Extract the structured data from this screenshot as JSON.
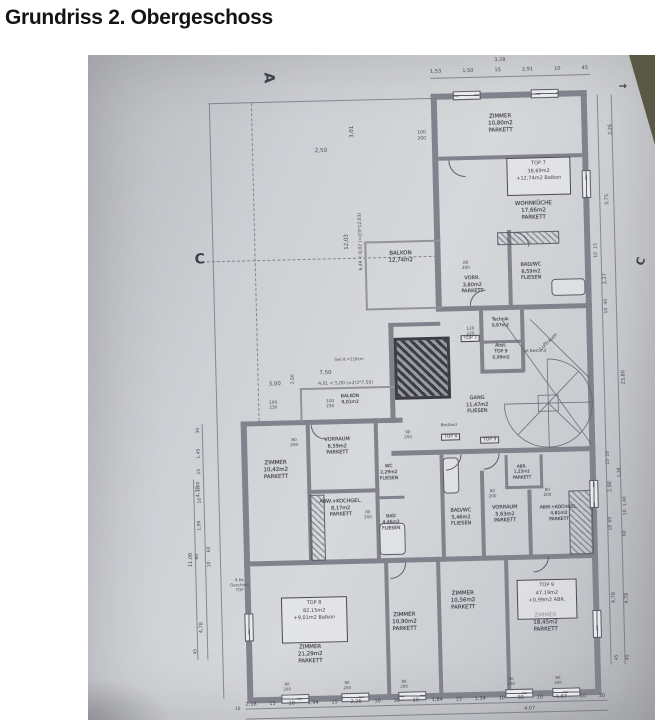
{
  "title": "Grundriss 2. Obergeschoss",
  "plan": {
    "section_markers": {
      "a": "A",
      "c_left": "C",
      "c_right": "C",
      "corner_arrow": "→"
    },
    "unit_boxes": [
      {
        "lines": [
          "TOP 7",
          "38,69m2",
          "+12,74m2 Balkon"
        ],
        "x": 424,
        "y": 106,
        "w": 58,
        "h": 32
      },
      {
        "lines": [
          "TOP 8",
          "82,15m2",
          "+9,01m2 Balkon"
        ],
        "x": 188,
        "y": 540,
        "w": 60,
        "h": 40
      },
      {
        "lines": [
          "TOP 9",
          "47,19m2",
          "+0,99m2 ABR."
        ],
        "x": 424,
        "y": 528,
        "w": 54,
        "h": 34
      }
    ],
    "door_labels": [
      {
        "t": "TOP 7",
        "x": 374,
        "y": 282
      },
      {
        "t": "TOP 8",
        "x": 352,
        "y": 380
      },
      {
        "t": "TOP 9",
        "x": 391,
        "y": 384
      }
    ],
    "rooms": [
      {
        "n": "ZIMMER",
        "a": "10,80m2",
        "f": "PARKETT",
        "x": 419,
        "y": 72
      },
      {
        "n": "WOHNKÜCHE",
        "a": "17,66m2",
        "f": "PARKETT",
        "x": 450,
        "y": 160
      },
      {
        "n": "BALKON",
        "a": "12,74m2",
        "x": 316,
        "y": 203
      },
      {
        "n": "VORR.",
        "a": "3,80m2",
        "f": "PARKETT",
        "x": 387,
        "y": 232,
        "s": 5
      },
      {
        "n": "BAD/WC",
        "a": "6,59m2",
        "f": "FLIESEN",
        "x": 446,
        "y": 220,
        "s": 5
      },
      {
        "n": "Technik",
        "a": "0,97m2",
        "x": 414,
        "y": 271,
        "s": 4.5
      },
      {
        "n": "Abst.",
        "a": "TOP 9",
        "f": "0,99m2",
        "x": 414,
        "y": 300,
        "s": 4.5
      },
      {
        "n": "GANG",
        "a": "11,47m2",
        "f": "FLIESEN",
        "x": 389,
        "y": 352,
        "s": 5
      },
      {
        "n": "BALKON",
        "a": "9,01m2",
        "x": 262,
        "y": 344,
        "s": 4.5
      },
      {
        "n": "VORRAUM",
        "a": "6,59m2",
        "f": "PARKETT",
        "x": 248,
        "y": 390,
        "s": 5
      },
      {
        "n": "ZIMMER",
        "a": "10,42m2",
        "f": "PARKETT",
        "x": 186,
        "y": 413,
        "s": 5.5
      },
      {
        "n": "WC",
        "a": "2,29m2",
        "f": "FLIESEN",
        "x": 299,
        "y": 418,
        "s": 4.5
      },
      {
        "n": "ABW.+KOCHGEL.",
        "a": "8,17m2",
        "f": "PARKETT",
        "x": 250,
        "y": 452,
        "s": 5
      },
      {
        "n": "BAD",
        "a": "4,46m2",
        "f": "FLIESEN",
        "x": 300,
        "y": 468,
        "s": 4.5
      },
      {
        "n": "BAD/WC",
        "a": "5,46m2",
        "f": "FLIESEN",
        "x": 370,
        "y": 464,
        "s": 5
      },
      {
        "n": "VORRAUM",
        "a": "5,63m2",
        "f": "PARKETT",
        "x": 414,
        "y": 462,
        "s": 5
      },
      {
        "n": "ABR.",
        "a": "1,23m2",
        "f": "PARKETT",
        "x": 432,
        "y": 420,
        "s": 4.2
      },
      {
        "n": "ABW.+KOCHGEL.",
        "a": "4,81m2",
        "f": "PARKETT",
        "x": 468,
        "y": 463,
        "s": 4.5
      },
      {
        "n": "ZIMMER",
        "a": "21,29m2",
        "f": "PARKETT",
        "x": 216,
        "y": 598,
        "s": 5.5
      },
      {
        "n": "ZIMMER",
        "a": "10,90m2",
        "f": "PARKETT",
        "x": 311,
        "y": 568,
        "s": 5.5
      },
      {
        "n": "ZIMMER",
        "a": "10,56m2",
        "f": "PARKETT",
        "x": 370,
        "y": 548,
        "s": 5.5
      },
      {
        "n": "ZIMMER",
        "a": "18,45m2",
        "f": "PARKETT",
        "x": 452,
        "y": 572,
        "s": 5.5
      }
    ],
    "annotations": [
      {
        "t": "3,01",
        "x": 271,
        "y": 76,
        "r": -90
      },
      {
        "t": "2,50",
        "x": 239,
        "y": 95
      },
      {
        "t": "100\n200",
        "x": 340,
        "y": 82,
        "s": 4.5
      },
      {
        "t": "12,03",
        "x": 263,
        "y": 186,
        "r": -90
      },
      {
        "t": "6,49 < 8,02 (=2/3*12,03)",
        "x": 277,
        "y": 186,
        "r": -90,
        "s": 4.5
      },
      {
        "t": "7,50",
        "x": 238,
        "y": 317
      },
      {
        "t": "4,01 < 5,00 (=2/3*7,50)",
        "x": 258,
        "y": 328,
        "s": 4.5
      },
      {
        "t": "3,00",
        "x": 187,
        "y": 327
      },
      {
        "t": "2,50",
        "x": 206,
        "y": 322,
        "r": -90,
        "s": 4.5
      },
      {
        "t": "100\n230",
        "x": 185,
        "y": 347,
        "s": 4.2
      },
      {
        "t": "100\n230",
        "x": 242,
        "y": 347,
        "s": 4.2
      },
      {
        "t": "120\n220",
        "x": 384,
        "y": 278,
        "s": 4.2
      },
      {
        "t": "80\n200",
        "x": 381,
        "y": 212,
        "s": 4.2
      },
      {
        "t": "90\n200",
        "x": 319,
        "y": 380,
        "s": 4.2
      },
      {
        "t": "80\n200",
        "x": 205,
        "y": 385,
        "s": 4.2
      },
      {
        "t": "80\n200",
        "x": 277,
        "y": 459,
        "s": 4.2
      },
      {
        "t": "80\n200",
        "x": 402,
        "y": 441,
        "s": 4.2
      },
      {
        "t": "80\n200",
        "x": 457,
        "y": 441,
        "s": 4.2
      },
      {
        "t": "Luftraum",
        "x": 462,
        "y": 291,
        "r": -42,
        "s": 5
      },
      {
        "t": "Gel.H.=118cm",
        "x": 262,
        "y": 303,
        "s": 4
      },
      {
        "t": "alt Bestand",
        "x": 448,
        "y": 299,
        "s": 4
      },
      {
        "t": "Bestand",
        "x": 360,
        "y": 371,
        "s": 4
      },
      {
        "t": "lt.Nr.\nGeschoss\nTOP",
        "x": 147,
        "y": 526,
        "s": 4
      },
      {
        "t": "80\n200",
        "x": 192,
        "y": 629,
        "s": 4
      },
      {
        "t": "80\n200",
        "x": 252,
        "y": 629,
        "s": 4
      },
      {
        "t": "80\n200",
        "x": 309,
        "y": 629,
        "s": 4
      },
      {
        "t": "80\n200",
        "x": 416,
        "y": 629,
        "s": 4
      },
      {
        "t": "80\n200",
        "x": 463,
        "y": 629,
        "s": 4
      },
      {
        "t": "3,28",
        "x": 420,
        "y": 8,
        "s": 5
      },
      {
        "t": "4,07",
        "x": 434,
        "y": 657,
        "s": 5
      },
      {
        "t": "10",
        "x": 142,
        "y": 651,
        "s": 4.5
      }
    ],
    "side_dims": [
      {
        "t": "11,06",
        "x": 99,
        "y": 500
      },
      {
        "t": "4,78",
        "x": 108,
        "y": 432
      },
      {
        "t": "4,78",
        "x": 108,
        "y": 568
      },
      {
        "t": "30",
        "x": 110,
        "y": 371,
        "s": 4.5
      },
      {
        "t": "1,45",
        "x": 110,
        "y": 394,
        "s": 4.5
      },
      {
        "t": "15",
        "x": 110,
        "y": 412,
        "s": 4.5
      },
      {
        "t": "1,00",
        "x": 109,
        "y": 427,
        "s": 4.5
      },
      {
        "t": "10",
        "x": 110,
        "y": 441,
        "s": 4.5
      },
      {
        "t": "1,98",
        "x": 109,
        "y": 466,
        "s": 4.5
      },
      {
        "t": "60",
        "x": 106,
        "y": 497,
        "s": 4.5
      },
      {
        "t": "60",
        "x": 118,
        "y": 490,
        "s": 4.5
      },
      {
        "t": "10",
        "x": 118,
        "y": 505,
        "s": 4.5
      },
      {
        "t": "45",
        "x": 102,
        "y": 592,
        "s": 4.5
      },
      {
        "t": "2,26",
        "x": 529,
        "y": 80
      },
      {
        "t": "3,75",
        "x": 524,
        "y": 150
      },
      {
        "t": "15",
        "x": 512,
        "y": 196,
        "s": 4.5
      },
      {
        "t": "10",
        "x": 512,
        "y": 205,
        "s": 4.5
      },
      {
        "t": "2,27",
        "x": 520,
        "y": 229
      },
      {
        "t": "40",
        "x": 521,
        "y": 252,
        "s": 4.5
      },
      {
        "t": "10",
        "x": 521,
        "y": 261,
        "s": 4.5
      },
      {
        "t": "23,80",
        "x": 536,
        "y": 328
      },
      {
        "t": "10",
        "x": 519,
        "y": 404,
        "s": 4.5
      },
      {
        "t": "15",
        "x": 519,
        "y": 412,
        "s": 4.5
      },
      {
        "t": "1,38",
        "x": 530,
        "y": 423,
        "s": 4.5
      },
      {
        "t": "2,98",
        "x": 520,
        "y": 437
      },
      {
        "t": "1,40",
        "x": 535,
        "y": 452,
        "s": 4.5
      },
      {
        "t": "10",
        "x": 535,
        "y": 463,
        "s": 4.5
      },
      {
        "t": "60",
        "x": 520,
        "y": 470,
        "s": 4.5
      },
      {
        "t": "10",
        "x": 520,
        "y": 478,
        "s": 4.5
      },
      {
        "t": "60",
        "x": 534,
        "y": 484,
        "s": 4.5
      },
      {
        "t": "4,78",
        "x": 521,
        "y": 548
      },
      {
        "t": "4,78",
        "x": 534,
        "y": 549
      },
      {
        "t": "45",
        "x": 523,
        "y": 608,
        "s": 4.5
      },
      {
        "t": "45",
        "x": 534,
        "y": 608,
        "s": 4.5
      }
    ],
    "dims": {
      "top_chain": [
        "1,53",
        "1,50",
        "15",
        "2,91",
        "10",
        "45"
      ],
      "bottom_chain": [
        "2,18",
        "15",
        "10",
        "1,94",
        "15",
        "2,26",
        "10",
        "30",
        "10",
        "1,84",
        "15",
        "1,34",
        "10",
        "89",
        "10",
        "1,67",
        "10",
        "30"
      ]
    }
  }
}
